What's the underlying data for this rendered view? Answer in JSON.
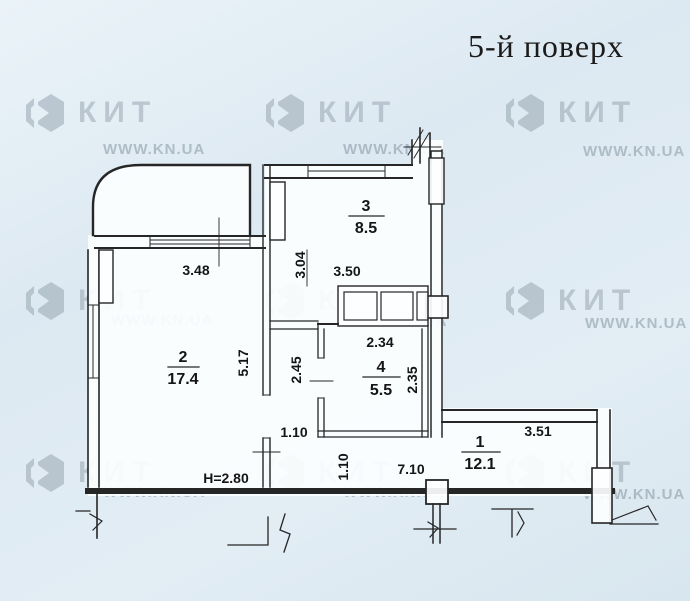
{
  "title": "5-й поверх",
  "watermark": {
    "brand": "КИТ",
    "url": "WWW.KN.UA"
  },
  "plan": {
    "rooms": [
      {
        "number": "1",
        "area": "12.1"
      },
      {
        "number": "2",
        "area": "17.4"
      },
      {
        "number": "3",
        "area": "8.5"
      },
      {
        "number": "4",
        "area": "5.5"
      }
    ],
    "dims": {
      "room2_top": "3.48",
      "kitchen_left_v": "3.04",
      "kitchen_width": "3.50",
      "bath_top": "2.34",
      "bath_right_v": "2.35",
      "corridor_v": "2.45",
      "room2_right_v": "5.17",
      "corridor_width": "1.10",
      "hall_left_v": "1.10",
      "hall_width": "7.10",
      "hall_top": "3.51",
      "ceiling_height": "H=2.80"
    }
  }
}
